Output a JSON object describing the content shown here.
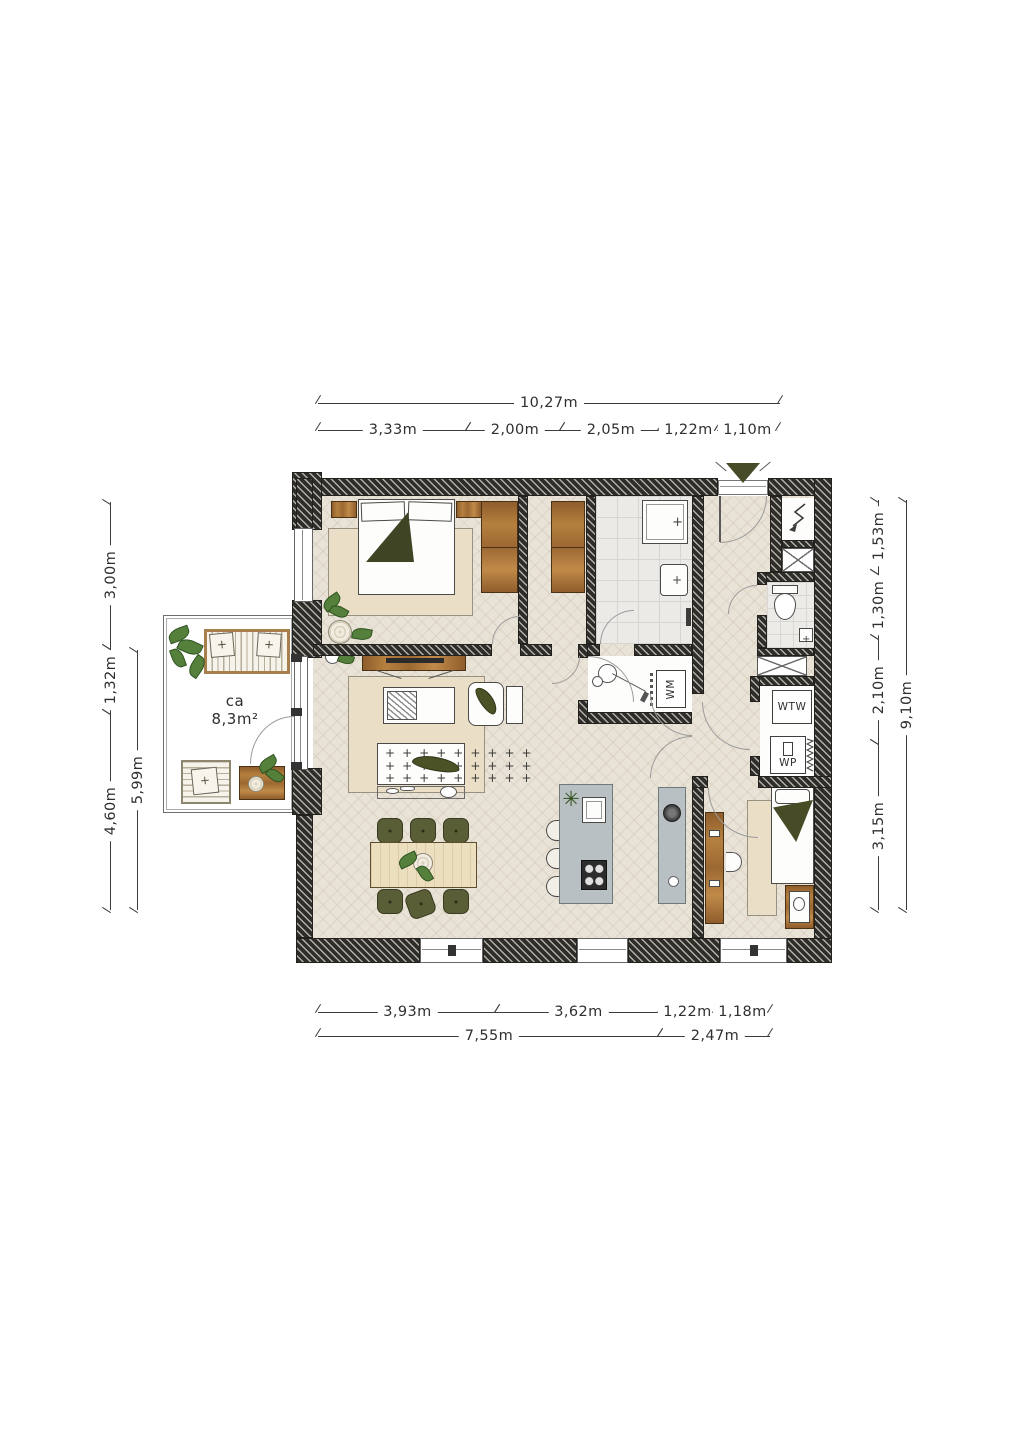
{
  "dims": {
    "top_total": "10,27m",
    "top_segments": [
      "3,33m",
      "2,00m",
      "2,05m",
      "1,22m",
      "1,10m"
    ],
    "bottom_segments": [
      "3,93m",
      "3,62m",
      "1,22m",
      "1,18m"
    ],
    "bottom_totals": [
      "7,55m",
      "2,47m"
    ],
    "left_segments": [
      "3,00m",
      "1,32m",
      "4,60m"
    ],
    "left_inner_total": "5,99m",
    "right_segments": [
      "1,53m",
      "1,30m",
      "2,10m",
      "3,15m"
    ],
    "right_total": "9,10m"
  },
  "balcony": {
    "area_prefix": "ca",
    "area_value": "8,3m²"
  },
  "equipment": {
    "washing_machine": "WM",
    "ventilation_unit": "WTW",
    "heat_pump": "WP"
  },
  "colors": {
    "wall": "#2e2d29",
    "floor": "#e9e3d7",
    "wood": "#a9713d",
    "olive": "#5a5e36",
    "tile": "#ebeae7",
    "counter": "#b9c0c4",
    "rug": "#eadfc6",
    "plant_green": "#55803c",
    "entrance_marker": "#474b28"
  }
}
